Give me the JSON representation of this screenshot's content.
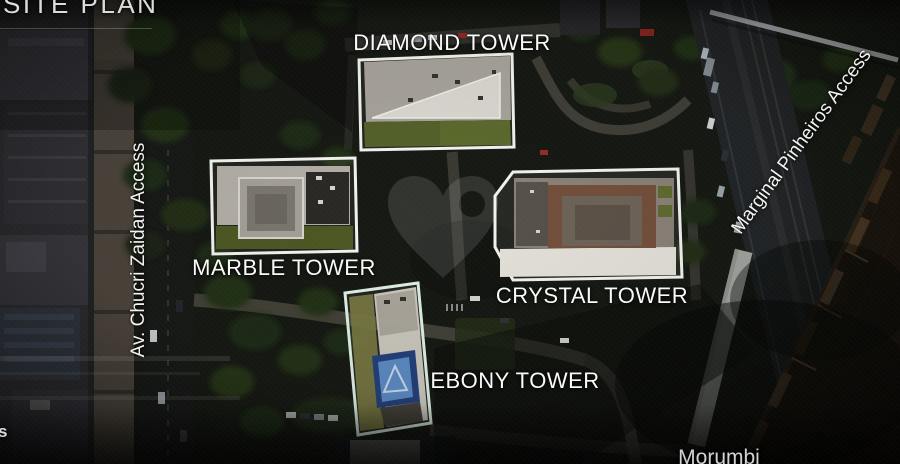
{
  "page": {
    "title": "SITE PLAN"
  },
  "towers": [
    {
      "id": "diamond-tower",
      "label": "DIAMOND TOWER"
    },
    {
      "id": "marble-tower",
      "label": "MARBLE TOWER"
    },
    {
      "id": "crystal-tower",
      "label": "CRYSTAL TOWER"
    },
    {
      "id": "ebony-tower",
      "label": "EBONY TOWER"
    }
  ],
  "streets": {
    "left_vertical": {
      "label": "Av. Chucri Zaidan Access"
    },
    "right_diagonal": {
      "label": "Marginal Pinheiros Access"
    },
    "bottom": {
      "label": "Morumbi"
    },
    "left_edge_fragment": {
      "label": "s"
    }
  },
  "watermark": {
    "icon": "heart-logo"
  },
  "colors": {
    "tower_outline": "#f4f4f0",
    "ebony_outline": "#dff0e6",
    "label_text": "#ffffff",
    "diamond_roof_green": "#5c6a2d",
    "marble_roof_green": "#4d5824",
    "crystal_roof_brown": "#74503c",
    "ebony_helipad_blue": "#5c8ac2",
    "river_water": "#1d160e"
  }
}
